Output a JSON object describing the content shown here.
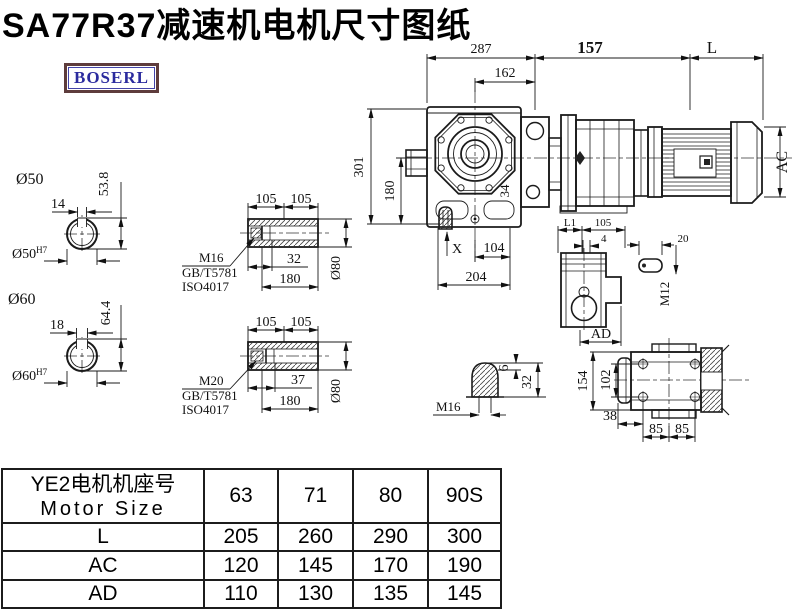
{
  "title": "SA77R37减速机电机尺寸图纸",
  "logo": {
    "text": "BOSERL"
  },
  "colors": {
    "line": "#1b1b1b",
    "logo_text": "#2b2b9e",
    "logo_border": "#5e3c3c"
  },
  "assembly": {
    "dim_287": "287",
    "dim_162": "162",
    "dim_157": "157",
    "dim_L": "L",
    "dim_301": "301",
    "dim_180": "180",
    "dim_34": "34",
    "dim_X": "X",
    "dim_104": "104",
    "dim_204": "204",
    "dim_AC": "AC"
  },
  "shaft50": {
    "title": "Ø50",
    "key_w": "14",
    "key_h": "53.8",
    "bore": "Ø50",
    "tol": "H7"
  },
  "shaft60": {
    "title": "Ø60",
    "key_w": "18",
    "key_h": "64.4",
    "bore": "Ø60",
    "tol": "H7"
  },
  "sleeve1": {
    "len_a": "105",
    "len_b": "105",
    "thread": "M16",
    "std_gb": "GB/T5781",
    "std_iso": "ISO4017",
    "depth": "32",
    "length": "180",
    "dia": "Ø80"
  },
  "sleeve2": {
    "len_a": "105",
    "len_b": "105",
    "thread": "M20",
    "std_gb": "GB/T5781",
    "std_iso": "ISO4017",
    "depth": "37",
    "length": "180",
    "dia": "Ø80"
  },
  "plug": {
    "thread": "M16",
    "tip": "6",
    "length": "32"
  },
  "small_view": {
    "dim_l1": "L1",
    "dim_105": "105",
    "dim_4": "4",
    "dim_ad": "AD"
  },
  "key_detail": {
    "dim_20": "20",
    "thread": "M12"
  },
  "back_view": {
    "height": "154",
    "bolt_v": "102",
    "offset": "38",
    "pitch_a": "85",
    "pitch_b": "85"
  },
  "table": {
    "header_cn": "YE2电机机座号",
    "header_en": "Motor Size",
    "columns": [
      "63",
      "71",
      "80",
      "90S"
    ],
    "rows": [
      {
        "label": "L",
        "values": [
          "205",
          "260",
          "290",
          "300"
        ]
      },
      {
        "label": "AC",
        "values": [
          "120",
          "145",
          "170",
          "190"
        ]
      },
      {
        "label": "AD",
        "values": [
          "110",
          "130",
          "135",
          "145"
        ]
      }
    ]
  }
}
